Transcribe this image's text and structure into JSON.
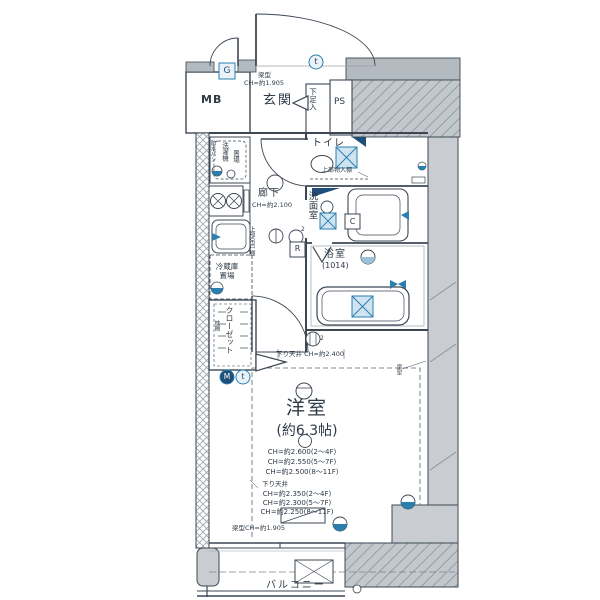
{
  "rooms": {
    "mb": "MB",
    "entrance": "玄関",
    "shoe_cupboard": "下足入",
    "ps": "PS",
    "toilet": "トイレ",
    "corridor": "廊下",
    "washroom": "洗面室",
    "bathroom": "浴室",
    "bathroom_size": "(1014)",
    "bedroom": "洋室",
    "bedroom_size": "(約6.3帖)",
    "closet": "クローゼット",
    "balcony": "バルコニー"
  },
  "labels": {
    "entrance_beam_1": "梁型",
    "entrance_beam_2": "CH=約1.905",
    "corridor_ch": "CH=約2.100",
    "toilet_upper_shelf": "上部物入棚",
    "waterproof_pan": "防水パン",
    "washer_place_1": "洗濯機",
    "washer_place_2": "置場",
    "upper_cupboard": "上部吊戸棚",
    "fridge_place": "冷蔵庫置場",
    "pillow_shelf": "枕棚",
    "lowered_ceiling_2400": "下り天井 CH=約2.400",
    "ch_upper_1": "CH=約2.600(2〜4F)",
    "ch_upper_2": "CH=約2.550(5〜7F)",
    "ch_upper_3": "CH=約2.500(8〜11F)",
    "lowered_ceiling": "下り天井",
    "ch_lower_1": "CH=約2.350(2〜4F)",
    "ch_lower_2": "CH=約2.300(5〜7F)",
    "ch_lower_3": "CH=約2.250(8〜11F)",
    "window_beam": "梁型CH=約1.905",
    "side_beam": "梁型"
  },
  "marks": {
    "gas": "G",
    "range": "R",
    "c": "C",
    "m": "M",
    "t_top": "t",
    "t_bottom": "t",
    "outlet2_corridor": "2",
    "outlet2_bath": "2"
  },
  "colors": {
    "line": "#3d4754",
    "accent_blue": "#2a7fae",
    "navy": "#1f4e79",
    "fixture_fill": "#cfe4f0",
    "wall_gray": "#c9cdd1"
  }
}
